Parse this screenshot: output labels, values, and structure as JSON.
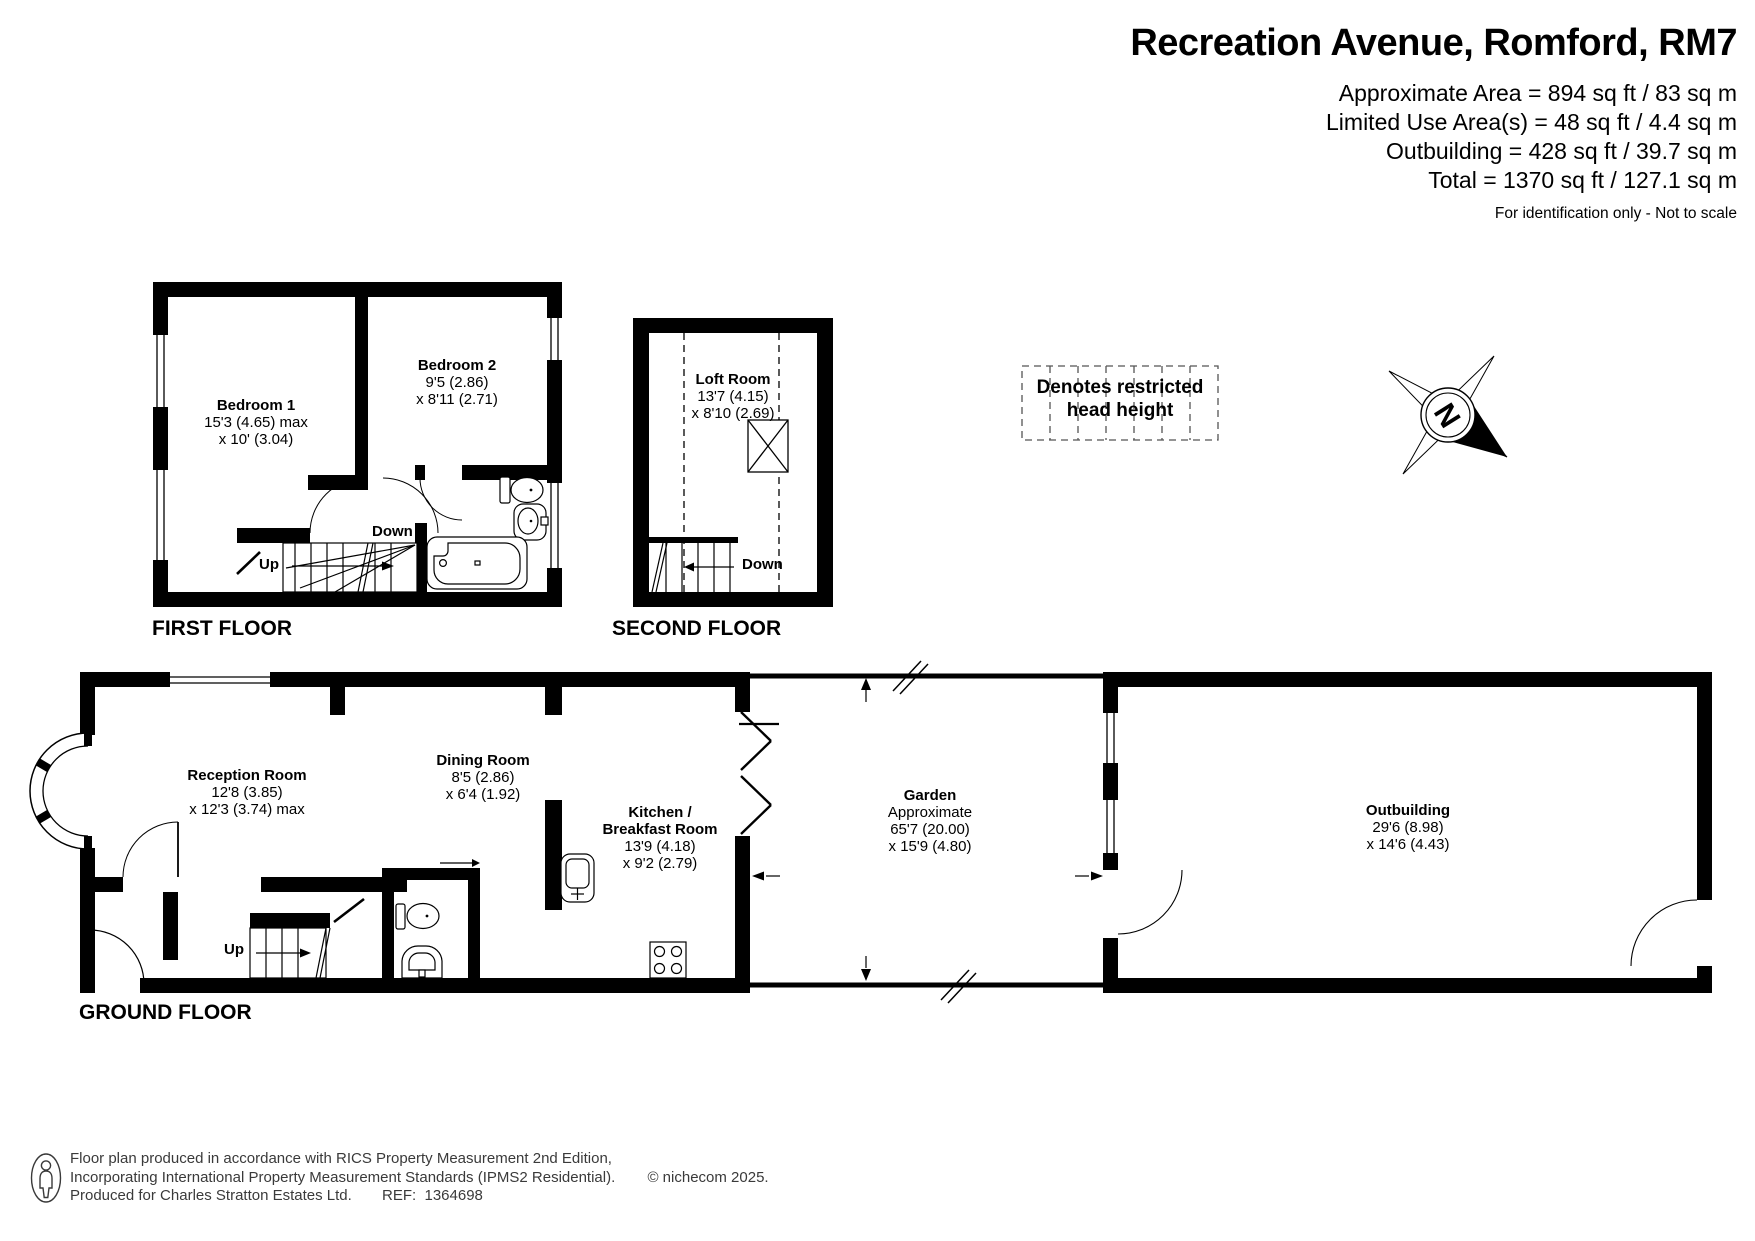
{
  "header": {
    "title": "Recreation Avenue, Romford, RM7",
    "area_lines": [
      "Approximate Area = 894 sq ft / 83 sq m",
      "Limited Use Area(s) = 48 sq ft / 4.4 sq m",
      "Outbuilding = 428 sq ft / 39.7 sq m",
      "Total = 1370 sq ft / 127.1 sq m"
    ],
    "note": "For identification only - Not to scale"
  },
  "floor_labels": {
    "first": "FIRST FLOOR",
    "second": "SECOND FLOOR",
    "ground": "GROUND FLOOR"
  },
  "stair_labels": {
    "up": "Up",
    "down": "Down"
  },
  "rooms": {
    "bedroom1": {
      "name": "Bedroom 1",
      "dim1": "15'3 (4.65) max",
      "dim2": "x 10' (3.04)"
    },
    "bedroom2": {
      "name": "Bedroom 2",
      "dim1": "9'5 (2.86)",
      "dim2": "x 8'11 (2.71)"
    },
    "loft": {
      "name": "Loft Room",
      "dim1": "13'7 (4.15)",
      "dim2": "x 8'10 (2.69)"
    },
    "reception": {
      "name": "Reception Room",
      "dim1": "12'8 (3.85)",
      "dim2": "x 12'3 (3.74) max"
    },
    "dining": {
      "name": "Dining Room",
      "dim1": "8'5 (2.86)",
      "dim2": "x 6'4 (1.92)"
    },
    "kitchen": {
      "name_line1": "Kitchen /",
      "name_line2": "Breakfast Room",
      "dim1": "13'9 (4.18)",
      "dim2": "x 9'2 (2.79)"
    },
    "garden": {
      "name": "Garden",
      "qualifier": "Approximate",
      "dim1": "65'7 (20.00)",
      "dim2": "x 15'9 (4.80)"
    },
    "outbuilding": {
      "name": "Outbuilding",
      "dim1": "29'6 (8.98)",
      "dim2": "x 14'6 (4.43)"
    }
  },
  "legend": {
    "line1": "Denotes restricted",
    "line2": "head height"
  },
  "compass": {
    "north": "N"
  },
  "footer": {
    "line1": "Floor plan produced in accordance with RICS Property Measurement 2nd Edition,",
    "line2": "Incorporating International Property Measurement Standards (IPMS2 Residential).",
    "copyright": "© nichecom 2025.",
    "line3": "Produced for Charles Stratton Estates Ltd.",
    "ref": "REF:  1364698"
  }
}
